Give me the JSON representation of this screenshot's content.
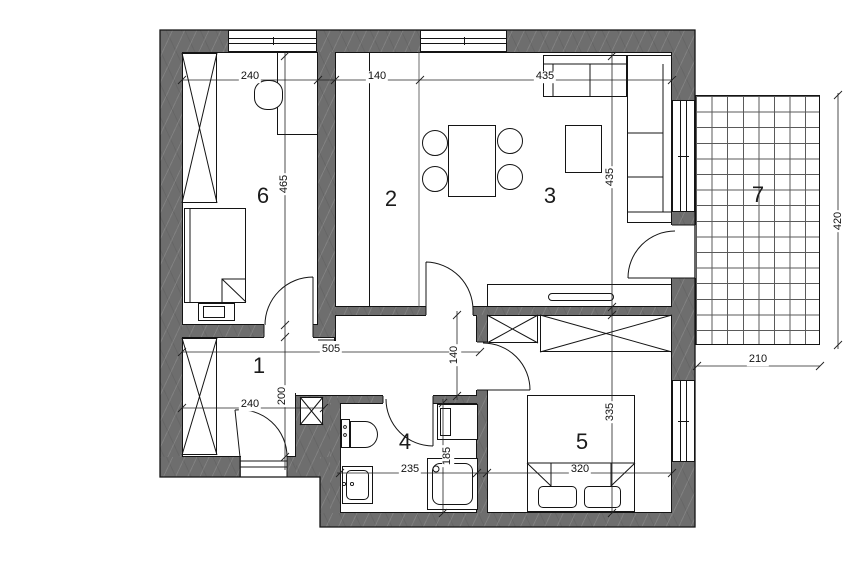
{
  "rooms": {
    "hall": {
      "label": "1"
    },
    "kitchen": {
      "label": "2"
    },
    "living": {
      "label": "3"
    },
    "bathroom": {
      "label": "4"
    },
    "bedroom2": {
      "label": "5"
    },
    "bedroom1": {
      "label": "6"
    },
    "terrace": {
      "label": "7"
    }
  },
  "dimensions": {
    "bedroom1_width": "240",
    "bedroom1_height": "465",
    "kitchen_width": "140",
    "living_width": "435",
    "living_height": "435",
    "hall_width": "505",
    "hall_entry_width": "240",
    "hall_height": "200",
    "corridor_height": "140",
    "bathroom_width": "235",
    "bathroom_height": "185",
    "bedroom2_width": "320",
    "bedroom2_height": "335",
    "terrace_width": "210",
    "terrace_height": "420"
  },
  "colors": {
    "wall": "#6e6e6e",
    "line": "#141414",
    "dim_line": "#222222",
    "grid_line": "#5a5a5a"
  }
}
